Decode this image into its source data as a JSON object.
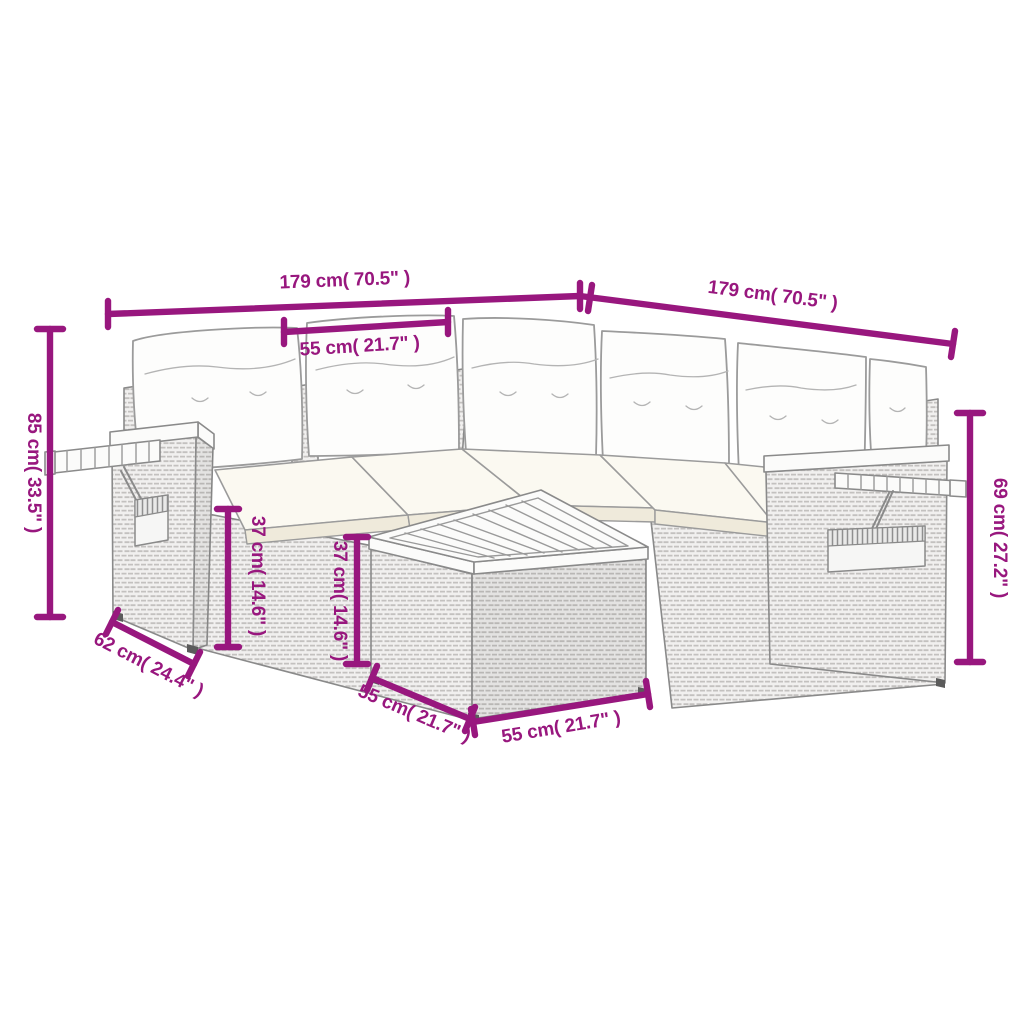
{
  "figure": {
    "kind": "product-dimension-diagram",
    "subject": "rattan-corner-sofa-set-with-side-table",
    "background": "#ffffff"
  },
  "colors": {
    "dimension_magenta": "#98177E",
    "line_art_gray": "#8a8a8a",
    "rattan_fill": "#f1f0ef",
    "cushion_white": "#fdfdfc",
    "seat_cream": "#efeadb"
  },
  "dimensions": {
    "width_left": {
      "label": "179 cm( 70.5\" )"
    },
    "width_right": {
      "label": "179 cm( 70.5\" )"
    },
    "backrest_width": {
      "label": "55 cm( 21.7\" )"
    },
    "total_height": {
      "label": "85 cm( 33.5\" )"
    },
    "seat_height_front": {
      "label": "37 cm( 14.6\" )"
    },
    "seat_height_mid": {
      "label": "37 cm( 14.6\" )"
    },
    "back_height": {
      "label": "69 cm( 27.2\" )"
    },
    "armrest_depth": {
      "label": "62 cm( 24.4\" )"
    },
    "table_side": {
      "label": "55 cm( 21.7\" )"
    },
    "table_front": {
      "label": "55 cm( 21.7\" )"
    }
  }
}
